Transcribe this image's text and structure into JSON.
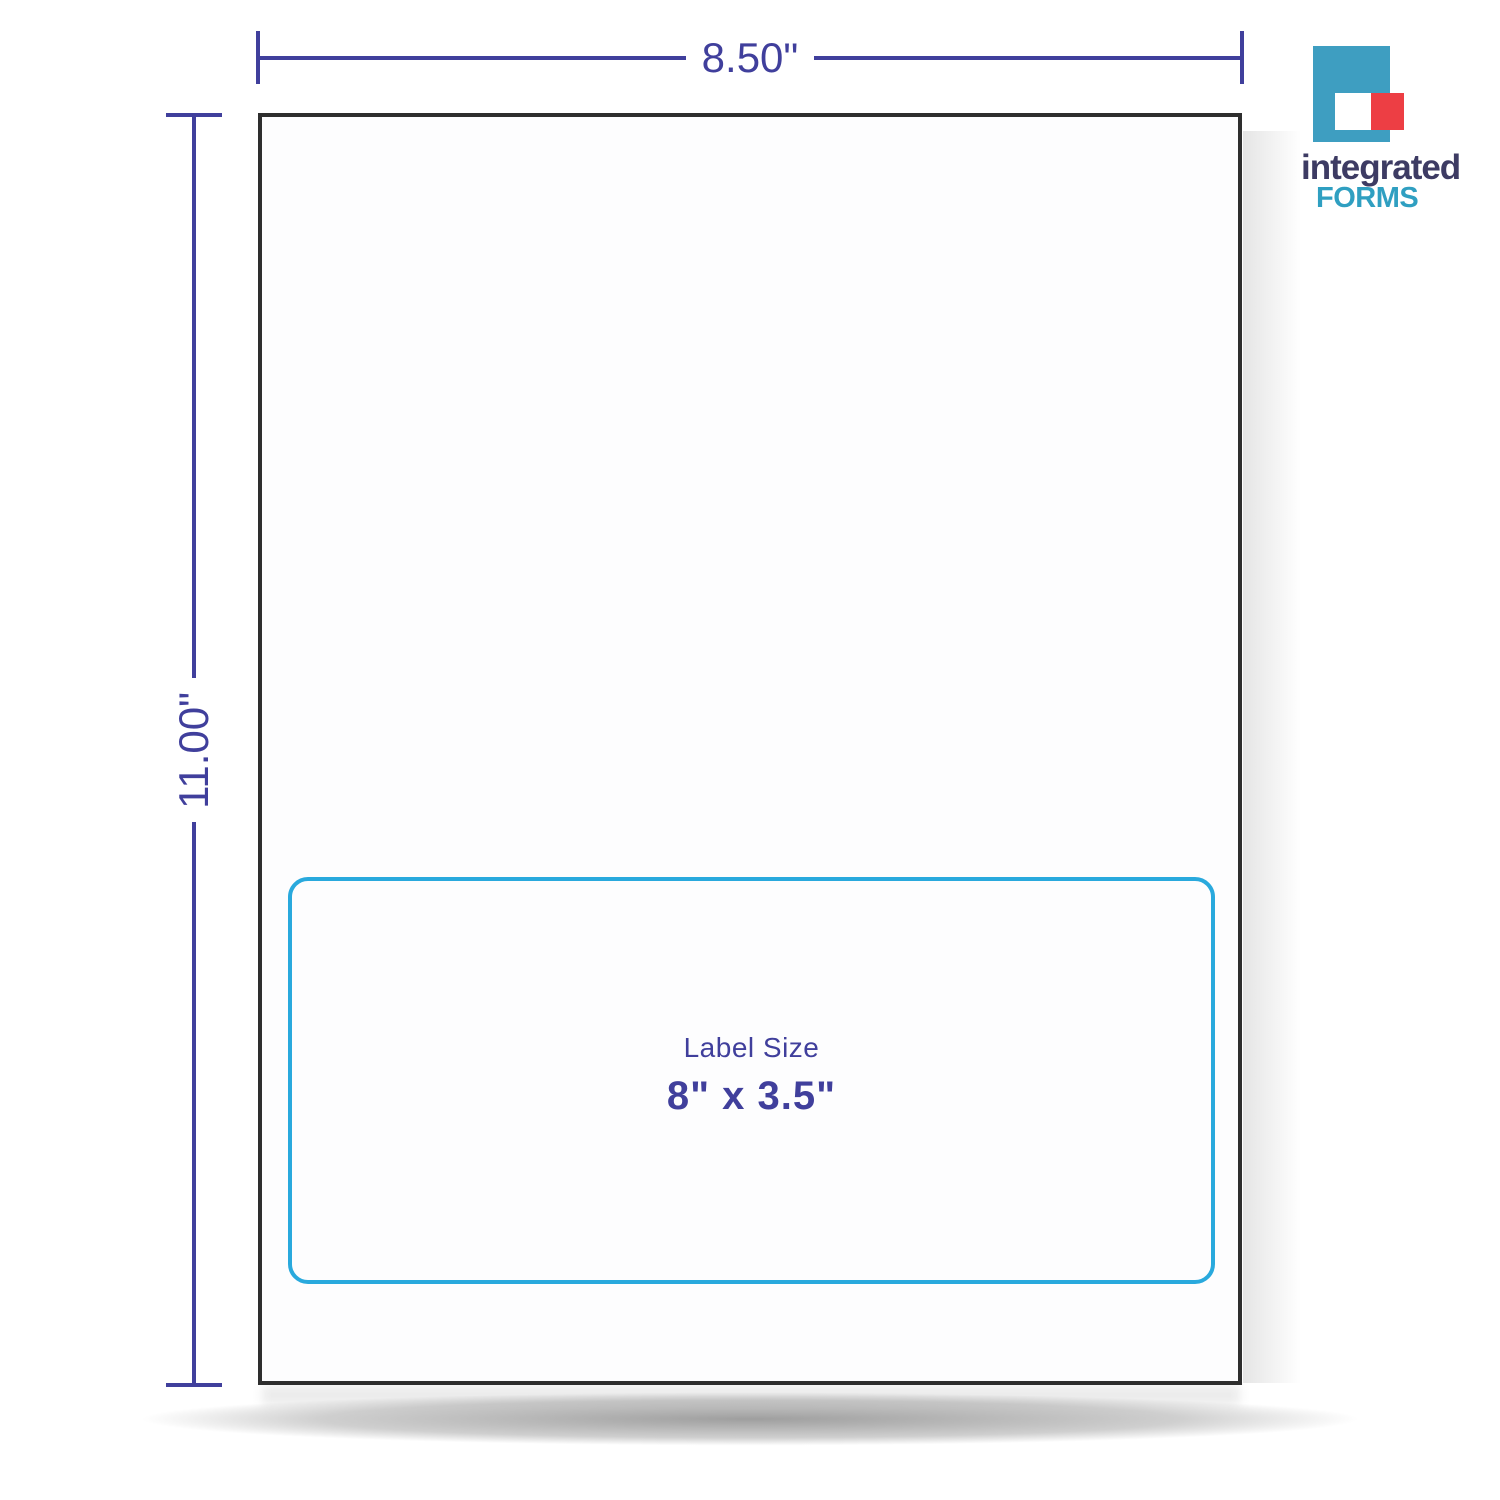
{
  "colors": {
    "indigo": "#403f9c",
    "cyan": "#29a9dd",
    "ink": "#2e2e2e",
    "logo-teal": "#3e9ec1",
    "logo-red": "#ed3e44",
    "logo-navy": "#3d3b63",
    "logo-forms-teal": "#2f9fc1"
  },
  "dimensions": {
    "width_label": "8.50\"",
    "height_label": "11.00\""
  },
  "label_area": {
    "title": "Label Size",
    "value": "8\" x 3.5\""
  },
  "logo": {
    "word1": "integrated",
    "word2": "FORMS"
  }
}
